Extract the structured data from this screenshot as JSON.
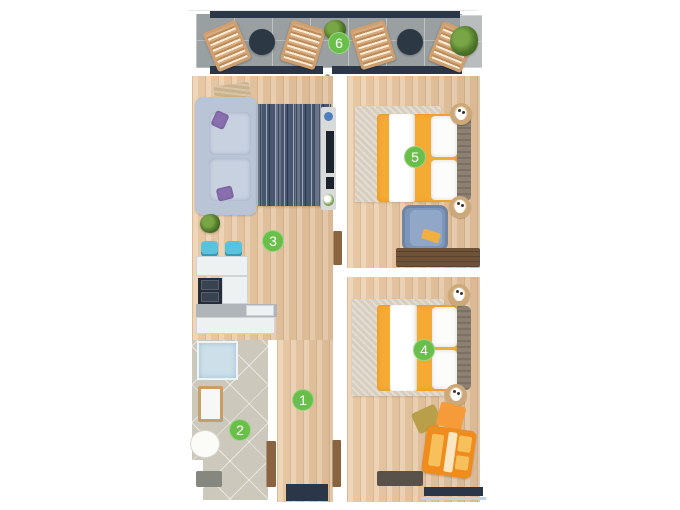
{
  "title": "Apartment floor plan",
  "colors": {
    "badge_green": "#6abf4b",
    "wood_floor": "#e8c7a2",
    "balcony_tile": "#9aa0a2",
    "bathroom_tile": "#cdc8bc",
    "window_navy": "#2b3648",
    "duvet_yellow": "#f5ab33",
    "lounge_orange": "#ef8c1d",
    "sofa_blue_gray": "#b9c4d6",
    "living_rug_navy": "#49566f",
    "door_brown": "#8a6340"
  },
  "rooms": [
    {
      "id": "hallway",
      "number": "1"
    },
    {
      "id": "bathroom",
      "number": "2"
    },
    {
      "id": "living-kitchen",
      "number": "3"
    },
    {
      "id": "bedroom-lower",
      "number": "4"
    },
    {
      "id": "bedroom-upper",
      "number": "5"
    },
    {
      "id": "balcony",
      "number": "6"
    }
  ]
}
